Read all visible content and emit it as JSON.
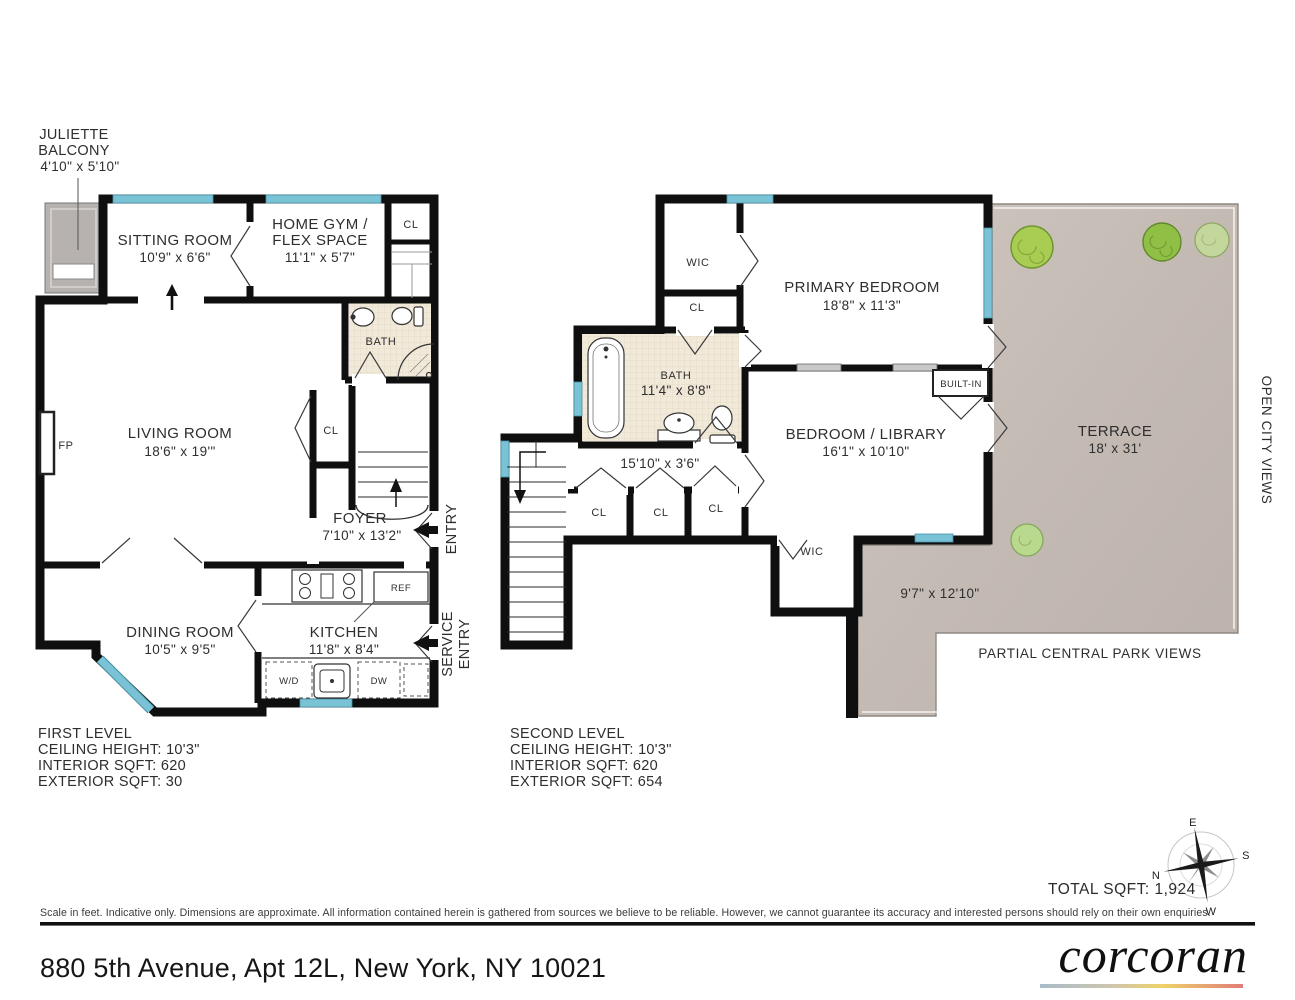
{
  "shared": {
    "cl": "CL",
    "wic": "WIC",
    "bath": "BATH"
  },
  "first_level": {
    "title": "FIRST LEVEL",
    "ceiling_height": "CEILING HEIGHT: 10'3\"",
    "interior_sqft": "INTERIOR SQFT: 620",
    "exterior_sqft": "EXTERIOR SQFT: 30",
    "juliette_balcony": {
      "line1": "JULIETTE",
      "line2": "BALCONY",
      "dims": "4'10\" x 5'10\""
    },
    "sitting_room": {
      "name": "SITTING ROOM",
      "dims": "10'9\" x 6'6\""
    },
    "home_gym": {
      "line1": "HOME GYM /",
      "line2": "FLEX SPACE",
      "dims": "11'1\" x 5'7\""
    },
    "living_room": {
      "name": "LIVING ROOM",
      "dims": "18'6\" x 19'\""
    },
    "foyer": {
      "name": "FOYER",
      "dims": "7'10\" x 13'2\""
    },
    "dining_room": {
      "name": "DINING ROOM",
      "dims": "10'5\" x 9'5\""
    },
    "kitchen": {
      "name": "KITCHEN",
      "dims": "11'8\" x 8'4\""
    },
    "labels": {
      "fp": "FP",
      "ref": "REF",
      "wd": "W/D",
      "dw": "DW",
      "entry": "ENTRY",
      "service1": "SERVICE",
      "service2": "ENTRY"
    }
  },
  "second_level": {
    "title": "SECOND LEVEL",
    "ceiling_height": "CEILING HEIGHT: 10'3\"",
    "interior_sqft": "INTERIOR SQFT: 620",
    "exterior_sqft": "EXTERIOR SQFT: 654",
    "primary_bedroom": {
      "name": "PRIMARY BEDROOM",
      "dims": "18'8\" x 11'3\""
    },
    "bedroom_library": {
      "name": "BEDROOM / LIBRARY",
      "dims": "16'1\" x 10'10\""
    },
    "bath": {
      "name": "BATH",
      "dims": "11'4\" x 8'8\""
    },
    "hallway": {
      "dims": "15'10\" x 3'6\""
    },
    "terrace": {
      "name": "TERRACE",
      "dims": "18' x 31'",
      "lower_dims": "9'7\" x 12'10\""
    },
    "views": {
      "open_city": "OPEN CITY VIEWS",
      "central_park": "PARTIAL CENTRAL PARK VIEWS"
    },
    "labels": {
      "built_in": "BUILT-IN"
    }
  },
  "compass": {
    "n": "N",
    "e": "E",
    "s": "S",
    "w": "W"
  },
  "summary": {
    "total_sqft": "TOTAL SQFT: 1,924"
  },
  "footer": {
    "disclaimer": "Scale in feet. Indicative only. Dimensions are approximate. All information contained herein is gathered from sources we believe to be reliable. However, we cannot guarantee its accuracy and interested persons should rely on their own enquiries.",
    "address": "880 5th Avenue, Apt 12L, New York, NY 10021",
    "brand": "corcoran"
  },
  "colors": {
    "wall": "#0f0f0f",
    "window": "#7ac3d6",
    "bath_floor": "#f1e9da",
    "terrace": "#c8beb8",
    "balcony": "#b7b2b0",
    "tree_green": "#a9cc52"
  }
}
